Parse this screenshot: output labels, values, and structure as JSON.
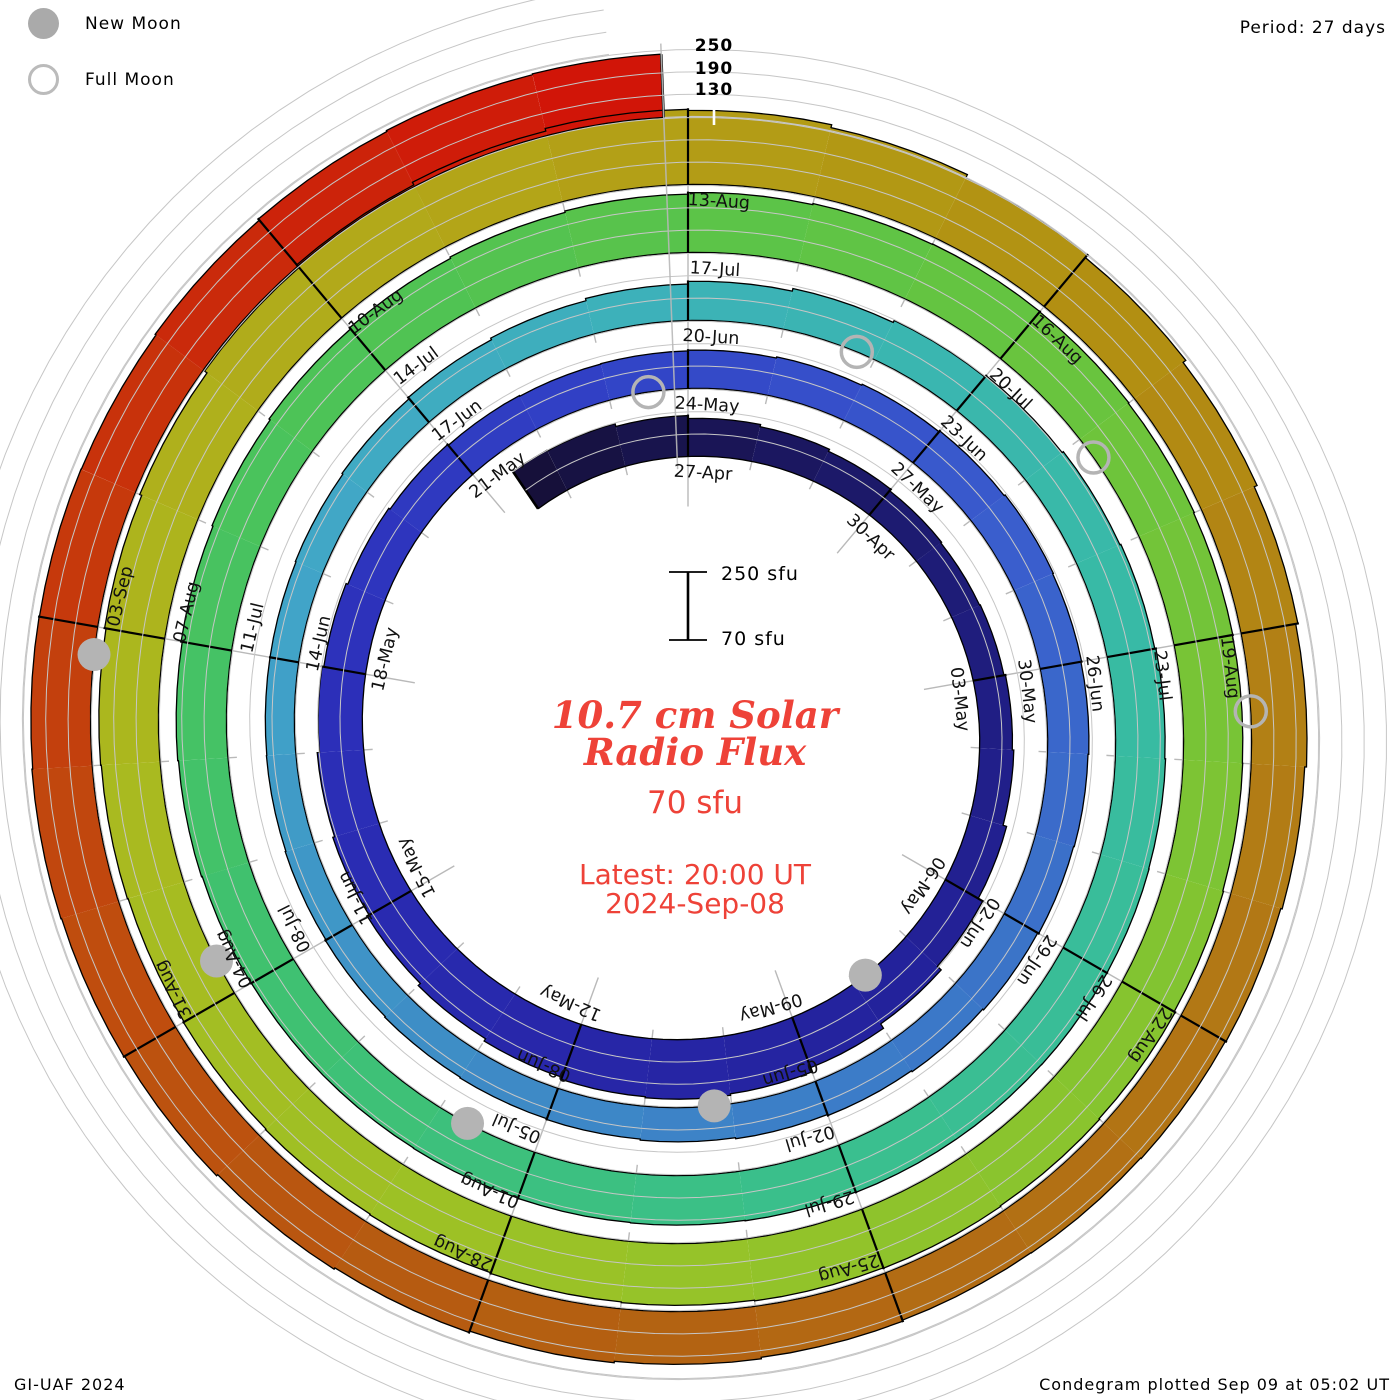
{
  "legend": {
    "new_moon": "New Moon",
    "full_moon": "Full Moon"
  },
  "header": {
    "period": "Period: 27 days"
  },
  "radial_scale_labels": [
    "250",
    "190",
    "130"
  ],
  "center": {
    "scale_top": "250 sfu",
    "scale_bottom": "70 sfu",
    "title_line1": "10.7 cm Solar",
    "title_line2": "Radio Flux",
    "baseline": "70 sfu",
    "latest_line1": "Latest: 20:00 UT",
    "latest_line2": "2024-Sep-08"
  },
  "footer": {
    "left": "GI-UAF 2024",
    "right": "Condegram plotted Sep 09 at 05:02 UT"
  },
  "colors": {
    "text_red": "#ee4238",
    "moon_gray": "#b4b4b4",
    "grid_gray": "#c6c6c6",
    "tick_gray": "#b9b9b9",
    "line_black": "#000000"
  },
  "chart_data": {
    "type": "bar",
    "subtype": "spiral-condegram",
    "title": "10.7 cm Solar Radio Flux",
    "period_days": 27,
    "baseline_sfu": 70,
    "gridlines_sfu": [
      130,
      190,
      250
    ],
    "series_start_date": "2024-04-24",
    "series_end": "2024-09-08 20:00 UT",
    "angle_labels_every_3_days": [
      "27-Apr",
      "30-Apr",
      "03-May",
      "06-May",
      "09-May",
      "12-May",
      "15-May",
      "18-May",
      "21-May",
      "24-May",
      "27-May",
      "30-May",
      "02-Jun",
      "05-Jun",
      "08-Jun",
      "11-Jun",
      "14-Jun",
      "17-Jun",
      "20-Jun",
      "23-Jun",
      "26-Jun",
      "29-Jun",
      "02-Jul",
      "05-Jul",
      "08-Jul",
      "11-Jul",
      "14-Jul",
      "17-Jul",
      "20-Jul",
      "23-Jul",
      "26-Jul",
      "29-Jul",
      "01-Aug",
      "04-Aug",
      "07-Aug",
      "10-Aug",
      "13-Aug",
      "16-Aug",
      "19-Aug",
      "22-Aug",
      "25-Aug",
      "28-Aug",
      "31-Aug",
      "03-Sep"
    ],
    "flux_sfu": [
      190,
      188,
      180,
      172,
      166,
      160,
      155,
      152,
      154,
      158,
      162,
      172,
      186,
      200,
      214,
      226,
      230,
      227,
      221,
      214,
      206,
      200,
      195,
      189,
      184,
      179,
      175,
      172,
      170,
      171,
      173,
      176,
      179,
      182,
      185,
      183,
      181,
      179,
      177,
      174,
      171,
      168,
      165,
      162,
      159,
      157,
      155,
      153,
      151,
      149,
      148,
      148,
      150,
      153,
      157,
      162,
      168,
      175,
      182,
      188,
      193,
      197,
      200,
      203,
      205,
      206,
      206,
      205,
      205,
      204,
      203,
      202,
      201,
      200,
      200,
      201,
      203,
      205,
      208,
      211,
      215,
      219,
      223,
      227,
      231,
      234,
      235,
      234,
      232,
      230,
      229,
      230,
      232,
      235,
      237,
      239,
      238,
      236,
      234,
      232,
      230,
      228,
      226,
      228,
      230,
      234,
      240,
      248,
      257,
      265,
      272,
      269,
      261,
      251,
      242,
      233,
      225,
      219,
      214,
      210,
      208,
      206,
      205,
      208,
      212,
      216,
      220,
      224,
      228,
      230,
      232,
      230,
      229,
      228,
      231,
      235,
      238,
      240
    ],
    "new_moons": [
      {
        "date": "08-May",
        "t": 10.8
      },
      {
        "date": "06-Jun",
        "t": 40.2
      },
      {
        "date": "05-Jul",
        "t": 69.7
      },
      {
        "date": "04-Aug",
        "t": 99.3
      },
      {
        "date": "03-Sep",
        "t": 128.8
      }
    ],
    "full_moons": [
      {
        "date": "23-May",
        "t": 26.5
      },
      {
        "date": "22-Jun",
        "t": 55.8
      },
      {
        "date": "21-Jul",
        "t": 85.2
      },
      {
        "date": "19-Aug",
        "t": 114.6
      }
    ],
    "colormap_stops": [
      [
        -3,
        "#150f35"
      ],
      [
        3,
        "#1d1a6e"
      ],
      [
        10,
        "#232199"
      ],
      [
        16,
        "#2828ac"
      ],
      [
        21,
        "#2c30ba"
      ],
      [
        26,
        "#3142c6"
      ],
      [
        31,
        "#3a5ccd"
      ],
      [
        37,
        "#3b76c8"
      ],
      [
        43,
        "#3e8cc6"
      ],
      [
        49,
        "#41a6c8"
      ],
      [
        54,
        "#3cb2b8"
      ],
      [
        60,
        "#38bba4"
      ],
      [
        66,
        "#3abf8d"
      ],
      [
        72,
        "#3fc170"
      ],
      [
        78,
        "#4ec355"
      ],
      [
        84,
        "#66c43f"
      ],
      [
        90,
        "#84c430"
      ],
      [
        96,
        "#9cc226"
      ],
      [
        101,
        "#aab91f"
      ],
      [
        106,
        "#b3a719"
      ],
      [
        111,
        "#b29112"
      ],
      [
        115,
        "#b27e15"
      ],
      [
        119,
        "#b26e14"
      ],
      [
        123,
        "#b45d11"
      ],
      [
        127,
        "#c04b0e"
      ],
      [
        131,
        "#c92e0b"
      ],
      [
        135,
        "#d21107"
      ]
    ]
  }
}
